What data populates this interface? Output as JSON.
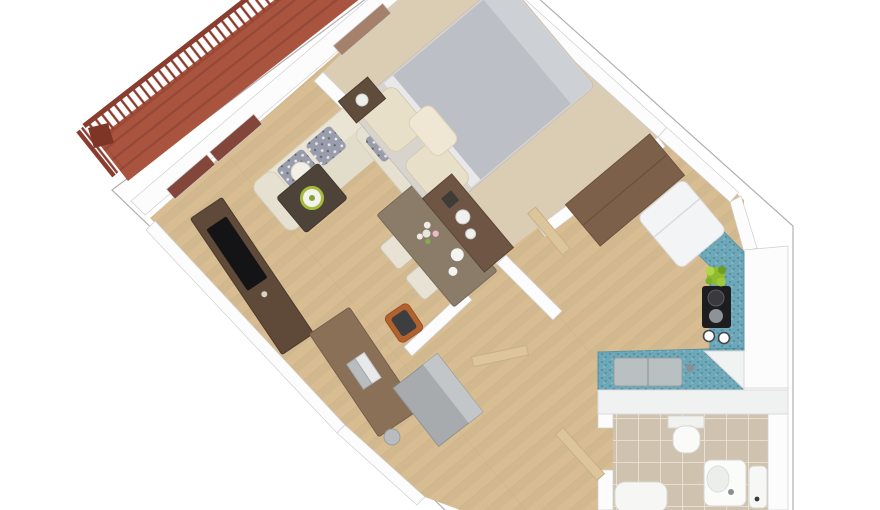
{
  "scene": {
    "kind": "3d-floor-plan-render",
    "description": "Top-down 3D perspective render of a one-bedroom apartment rotated about 40 degrees, with balcony, living room, bedroom, kitchen, hallway and bathroom on a white slab",
    "background": "#ffffff",
    "rotation_deg": -40
  },
  "rooms": [
    {
      "id": "balcony",
      "label": "Balcony",
      "floor": "terracotta decking",
      "items": [
        "wood railing with balusters",
        "corner post"
      ]
    },
    {
      "id": "living-room",
      "label": "Living Room",
      "floor": "light hardwood planks",
      "items": [
        "corner sofa with patterned cushions",
        "coffee table with decorative bowl",
        "tv console with flat tv",
        "desk with laptop",
        "orange desk chair",
        "round stool",
        "dining table with flower vase",
        "four dining chairs"
      ]
    },
    {
      "id": "bedroom",
      "label": "Bedroom",
      "floor": "beige carpet",
      "items": [
        "double bed with gray duvet and cream pillows",
        "nightstand with lamp",
        "dresser with round trays",
        "wardrobe",
        "open door"
      ]
    },
    {
      "id": "kitchen",
      "label": "Kitchen",
      "floor": "light hardwood planks",
      "items": [
        "teal mosaic L-counter",
        "black cooktop with pots",
        "counter sink",
        "refrigerator",
        "potted plant",
        "two jars"
      ]
    },
    {
      "id": "hallway",
      "label": "Hallway / Entry",
      "floor": "light hardwood planks",
      "items": [
        "gray storage cabinet",
        "open interior door",
        "open entry door"
      ]
    },
    {
      "id": "bathroom",
      "label": "Bathroom",
      "floor": "beige ceramic tile",
      "items": [
        "toilet",
        "washbasin",
        "bidet",
        "bathtub"
      ]
    }
  ],
  "colors": {
    "background": "#ffffff",
    "slab_edge": "#b0b0b0",
    "wall": "#fcfcfc",
    "wall_edge": "#cfcfcf",
    "balcony_floor": "#a9543f",
    "balcony_stripe": "#8e4434",
    "railing": "#8a3d2e",
    "window_glass": "#82463a",
    "window_glass_light": "#a5806b",
    "wood_floor": "#d8bd92",
    "wood_seam": "#c2a170",
    "bedroom_carpet": "#dbcdb4",
    "bathroom_tile": "#cfc3b0",
    "tile_grout": "#efe9dd",
    "counter": "#6ea7b8",
    "counter_speckle": "#3f7f95",
    "sofa": "#eae4d4",
    "cushion": "#989cab",
    "bed_duvet": "#bcc0c6",
    "bed_sheet": "#e8e8ea",
    "pillow": "#e8dfc9",
    "coffee_table": "#4e4339",
    "bowl_ring": "#a4bc3c",
    "tv_console": "#5f4938",
    "tv": "#141417",
    "desk": "#8b7058",
    "chair_orange": "#b2622f",
    "dining_table": "#8b7c69",
    "dining_chair_pattern": "#b6ae98",
    "dining_chair_light": "#e7e2d4",
    "wardrobe": "#7d6049",
    "dresser": "#6e5544",
    "nightstand": "#5f4c3b",
    "door": "#dcc49b",
    "fridge": "#f3f4f5",
    "cooktop": "#1d1d1f",
    "plant": "#8fbc2e",
    "closet_cabinet": "#a7abae",
    "fixture": "#fafaf8",
    "fixture_edge": "#d6d6d2",
    "sink_basin": "#b9c0c2"
  }
}
